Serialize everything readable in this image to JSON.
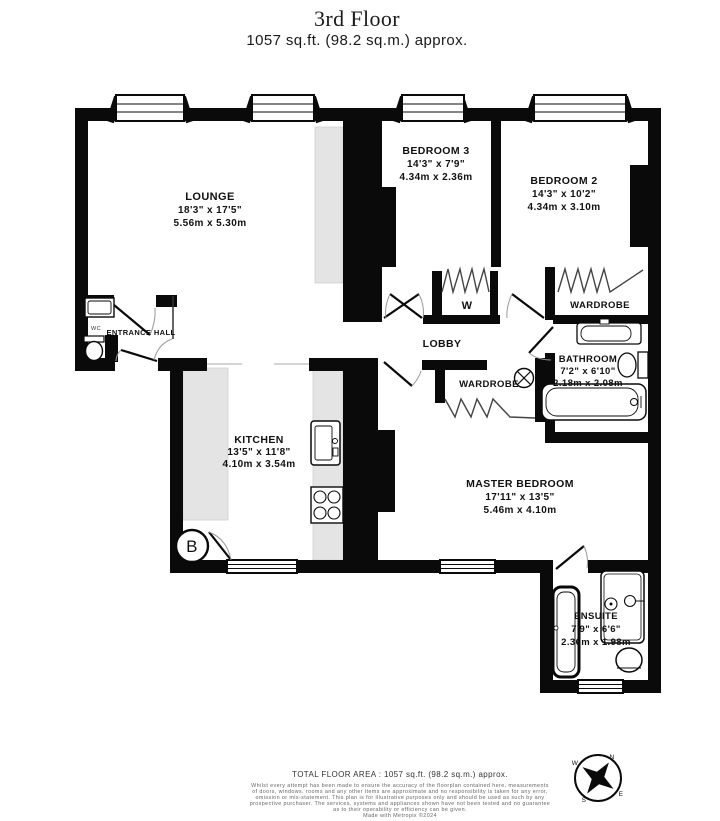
{
  "title": {
    "floor": "3rd Floor",
    "area": "1057 sq.ft. (98.2 sq.m.) approx."
  },
  "rooms": {
    "lounge": {
      "name": "LOUNGE",
      "imperial": "18'3\" x 17'5\"",
      "metric": "5.56m x 5.30m"
    },
    "bedroom3": {
      "name": "BEDROOM 3",
      "imperial": "14'3\" x 7'9\"",
      "metric": "4.34m x 2.36m"
    },
    "bedroom2": {
      "name": "BEDROOM 2",
      "imperial": "14'3\" x 10'2\"",
      "metric": "4.34m x 3.10m"
    },
    "kitchen": {
      "name": "KITCHEN",
      "imperial": "13'5\" x 11'8\"",
      "metric": "4.10m x 3.54m"
    },
    "bathroom": {
      "name": "BATHROOM",
      "imperial": "7'2\" x 6'10\"",
      "metric": "2.18m x 2.08m"
    },
    "master_bedroom": {
      "name": "MASTER BEDROOM",
      "imperial": "17'11\" x 13'5\"",
      "metric": "5.46m x 4.10m"
    },
    "ensuite": {
      "name": "ENSUITE",
      "imperial": "7'9\" x 6'6\"",
      "metric": "2.36m x 1.98m"
    },
    "entrance_hall": {
      "name": "ENTRANCE HALL"
    },
    "lobby": {
      "name": "LOBBY"
    },
    "wardrobe_small": {
      "name": "W"
    },
    "wardrobe_bedroom2": {
      "name": "WARDROBE"
    },
    "wardrobe_master": {
      "name": "WARDROBE"
    },
    "wc": {
      "name": "WC"
    }
  },
  "symbols": {
    "boiler": "B"
  },
  "compass": {
    "n": "N",
    "e": "E",
    "s": "S",
    "w": "W"
  },
  "footer": {
    "total_area": "TOTAL FLOOR AREA : 1057 sq.ft. (98.2 sq.m.) approx.",
    "disclaimer": [
      "Whilst every attempt has been made to ensure the accuracy of the floorplan contained here, measurements",
      "of doors, windows, rooms and any other items are approximate and no responsibility is taken for any error,",
      "omission or mis-statement. This plan is for illustrative purposes only and should be used as such by any",
      "prospective purchaser. The services, systems and appliances shown have not been tested and no guarantee",
      "as to their operability or efficiency can be given."
    ],
    "credit": "Made with Metropix ©2024"
  },
  "colors": {
    "wall": "#0a0a0a",
    "shading": "#e4e4e4"
  }
}
